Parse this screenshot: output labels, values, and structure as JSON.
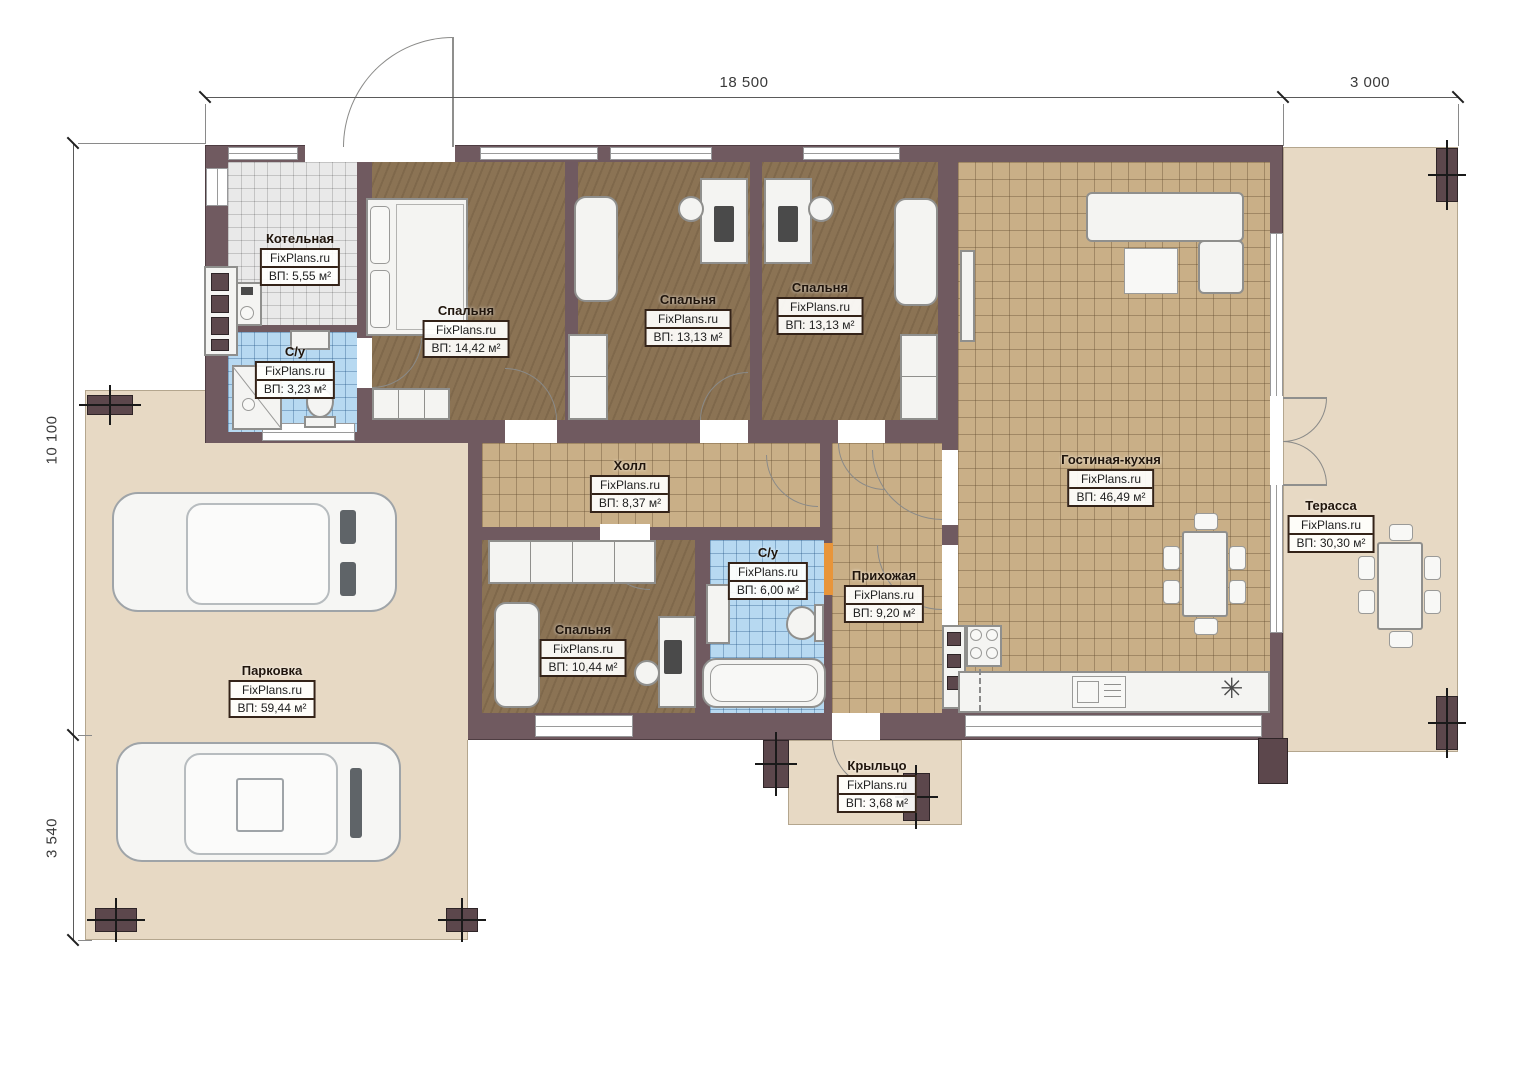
{
  "brand": "FixPlans.ru",
  "dimensions": {
    "top": [
      {
        "label": "18 500"
      },
      {
        "label": "3 000"
      }
    ],
    "left": [
      {
        "label": "10 100"
      },
      {
        "label": "3 540"
      }
    ]
  },
  "rooms": [
    {
      "name": "Котельная",
      "area": "ВП: 5,55 м²"
    },
    {
      "name": "С/у",
      "area": "ВП: 3,23 м²"
    },
    {
      "name": "Спальня",
      "area": "ВП: 14,42 м²"
    },
    {
      "name": "Спальня",
      "area": "ВП: 13,13 м²"
    },
    {
      "name": "Спальня",
      "area": "ВП: 13,13 м²"
    },
    {
      "name": "Гостиная-кухня",
      "area": "ВП: 46,49 м²"
    },
    {
      "name": "Холл",
      "area": "ВП: 8,37 м²"
    },
    {
      "name": "С/у",
      "area": "ВП: 6,00 м²"
    },
    {
      "name": "Прихожая",
      "area": "ВП: 9,20 м²"
    },
    {
      "name": "Спальня",
      "area": "ВП: 10,44 м²"
    },
    {
      "name": "Терасса",
      "area": "ВП: 30,30 м²"
    },
    {
      "name": "Парковка",
      "area": "ВП: 59,44 м²"
    },
    {
      "name": "Крыльцо",
      "area": "ВП: 3,68 м²"
    }
  ],
  "icons": {
    "fridge_symbol": "✳"
  },
  "colors": {
    "wall": "#705a60",
    "outdoor": "#e7d9c4",
    "tile_tan": "#c9af87",
    "tile_blue": "#b7d9f1",
    "tile_gray": "#e9e9e9",
    "wood": "#8b7354",
    "door_highlight": "#e8953a"
  }
}
